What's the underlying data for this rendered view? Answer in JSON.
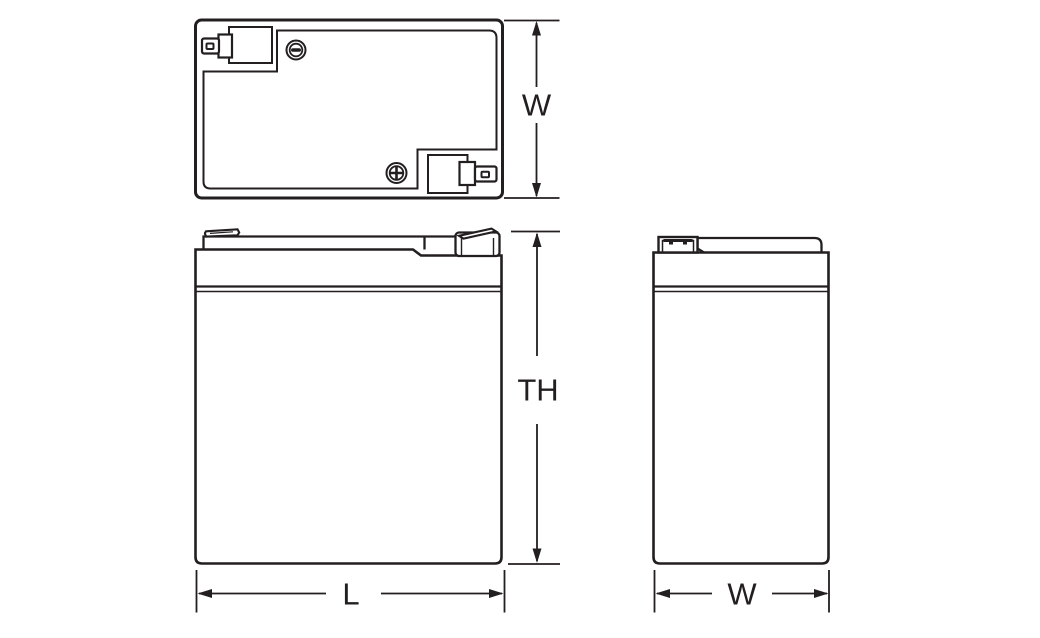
{
  "diagram": {
    "title": "Battery dimensional outline drawing (three orthographic views)",
    "line_color": "#231f20",
    "background": "#ffffff",
    "colors": {
      "negative_terminal": "#231f20",
      "positive_terminal": "#ed1c24",
      "body_fill": "#ffffff"
    },
    "views": {
      "top_view": {
        "name": "top view",
        "negative_terminal_mark": "minus-icon",
        "positive_terminal_mark": "plus-icon"
      },
      "front_view": {
        "name": "front view"
      },
      "side_view": {
        "name": "side view"
      }
    },
    "dimensions": {
      "width_top": {
        "label": "W"
      },
      "total_height": {
        "label": "TH"
      },
      "length": {
        "label": "L"
      },
      "width_side": {
        "label": "W"
      }
    }
  }
}
